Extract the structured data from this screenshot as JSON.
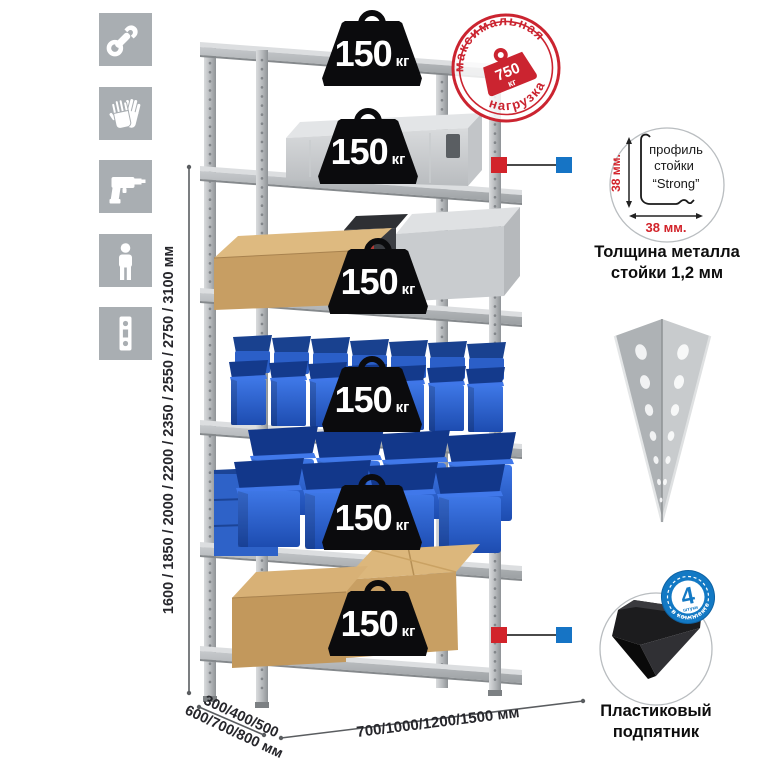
{
  "sidebar": {
    "icons": [
      {
        "name": "wrench-icon"
      },
      {
        "name": "gloves-icon"
      },
      {
        "name": "drill-icon"
      },
      {
        "name": "person-icon"
      },
      {
        "name": "perforated-strip-icon"
      }
    ]
  },
  "weights": [
    {
      "value": "150",
      "unit": "кг"
    },
    {
      "value": "150",
      "unit": "кг"
    },
    {
      "value": "150",
      "unit": "кг"
    },
    {
      "value": "150",
      "unit": "кг"
    },
    {
      "value": "150",
      "unit": "кг"
    },
    {
      "value": "150",
      "unit": "кг"
    }
  ],
  "stamp": {
    "arc_top": "максимальная",
    "arc_bottom": "нагрузка",
    "value": "750",
    "unit": "кг"
  },
  "profile_detail": {
    "line1": "профиль",
    "line2": "стойки",
    "line3": "“Strong”",
    "dim_vertical": "38 мм.",
    "dim_horizontal": "38 мм.",
    "caption_line1": "Толщина металла",
    "caption_line2": "стойки 1,2 мм"
  },
  "foot_detail": {
    "badge_number": "4",
    "badge_small": "штуки",
    "badge_arc": "в комплекте",
    "caption_line1": "Пластиковый",
    "caption_line2": "подпятник"
  },
  "dimensions": {
    "height": "1600 / 1850 / 2000 / 2200 / 2350 / 2550 / 2750 / 3100 мм",
    "depth_line1": "300/400/500",
    "depth_line2": "600/700/800 мм",
    "width": "700/1000/1200/1500 мм"
  },
  "colors": {
    "accent_red": "#cb2430",
    "accent_blue": "#1379c4",
    "metal_gray": "#b7babd",
    "bin_blue": "#2a5fc8",
    "cardboard": "#c89f63",
    "icon_bg": "#a9aeb2"
  }
}
